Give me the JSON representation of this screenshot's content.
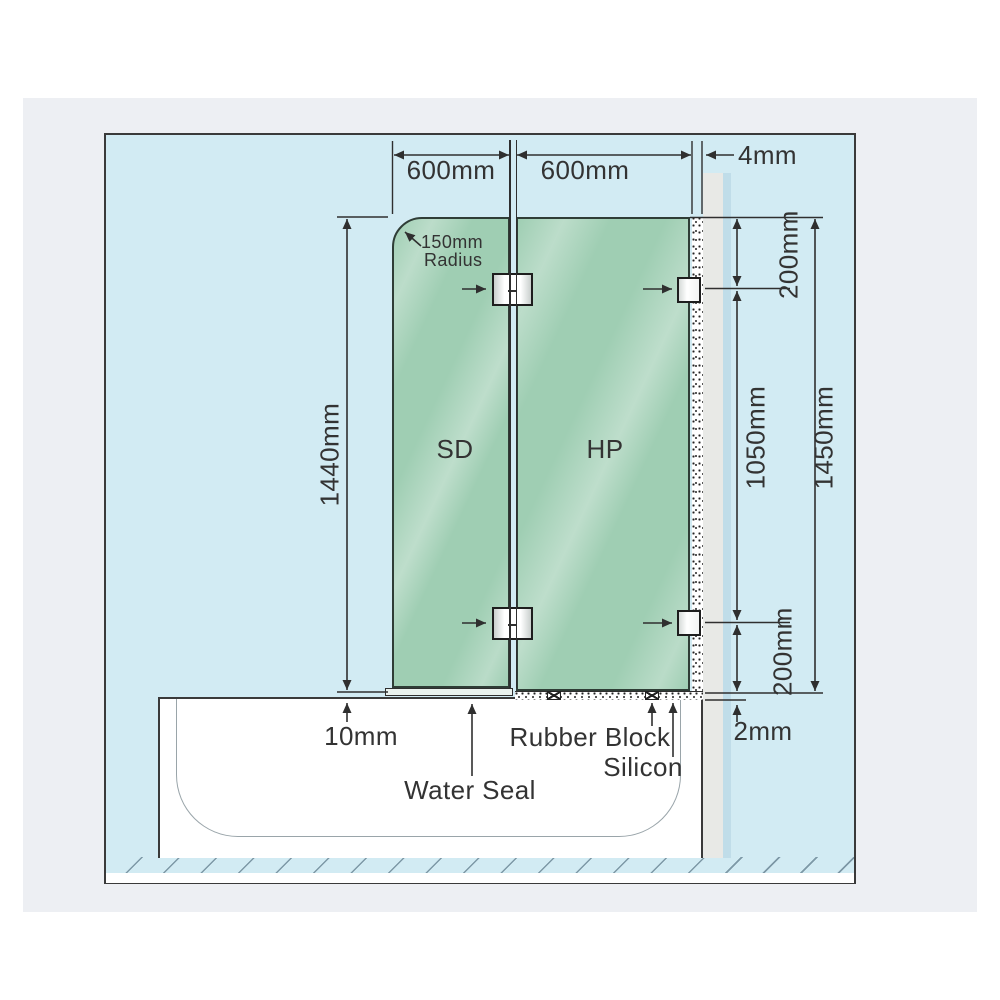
{
  "diagram": {
    "description": "Frameless bath shower screen installation diagram",
    "colors": {
      "background_blue": "#d2ebf3",
      "outer_gray": "#edeff3",
      "glass_green": "#9fceb3",
      "wall_gray": "#e8e9e6",
      "line_dark": "#2f2f2f"
    },
    "panels": {
      "door": "SD",
      "fixed": "HP"
    },
    "dims": {
      "sd_width": "600mm",
      "hp_width": "600mm",
      "wall_gap": "4mm",
      "corner_radius_line1": "150mm",
      "corner_radius_line2": "Radius",
      "sd_height": "1440mm",
      "hinge_top_offset": "200mm",
      "hinge_spacing": "1050mm",
      "hp_height": "1450mm",
      "hinge_bottom_offset": "200mm",
      "bottom_gap": "10mm",
      "hp_bottom_gap": "2mm"
    },
    "annotations": {
      "water_seal": "Water Seal",
      "rubber_block": "Rubber Block",
      "silicon": "Silicon"
    }
  }
}
